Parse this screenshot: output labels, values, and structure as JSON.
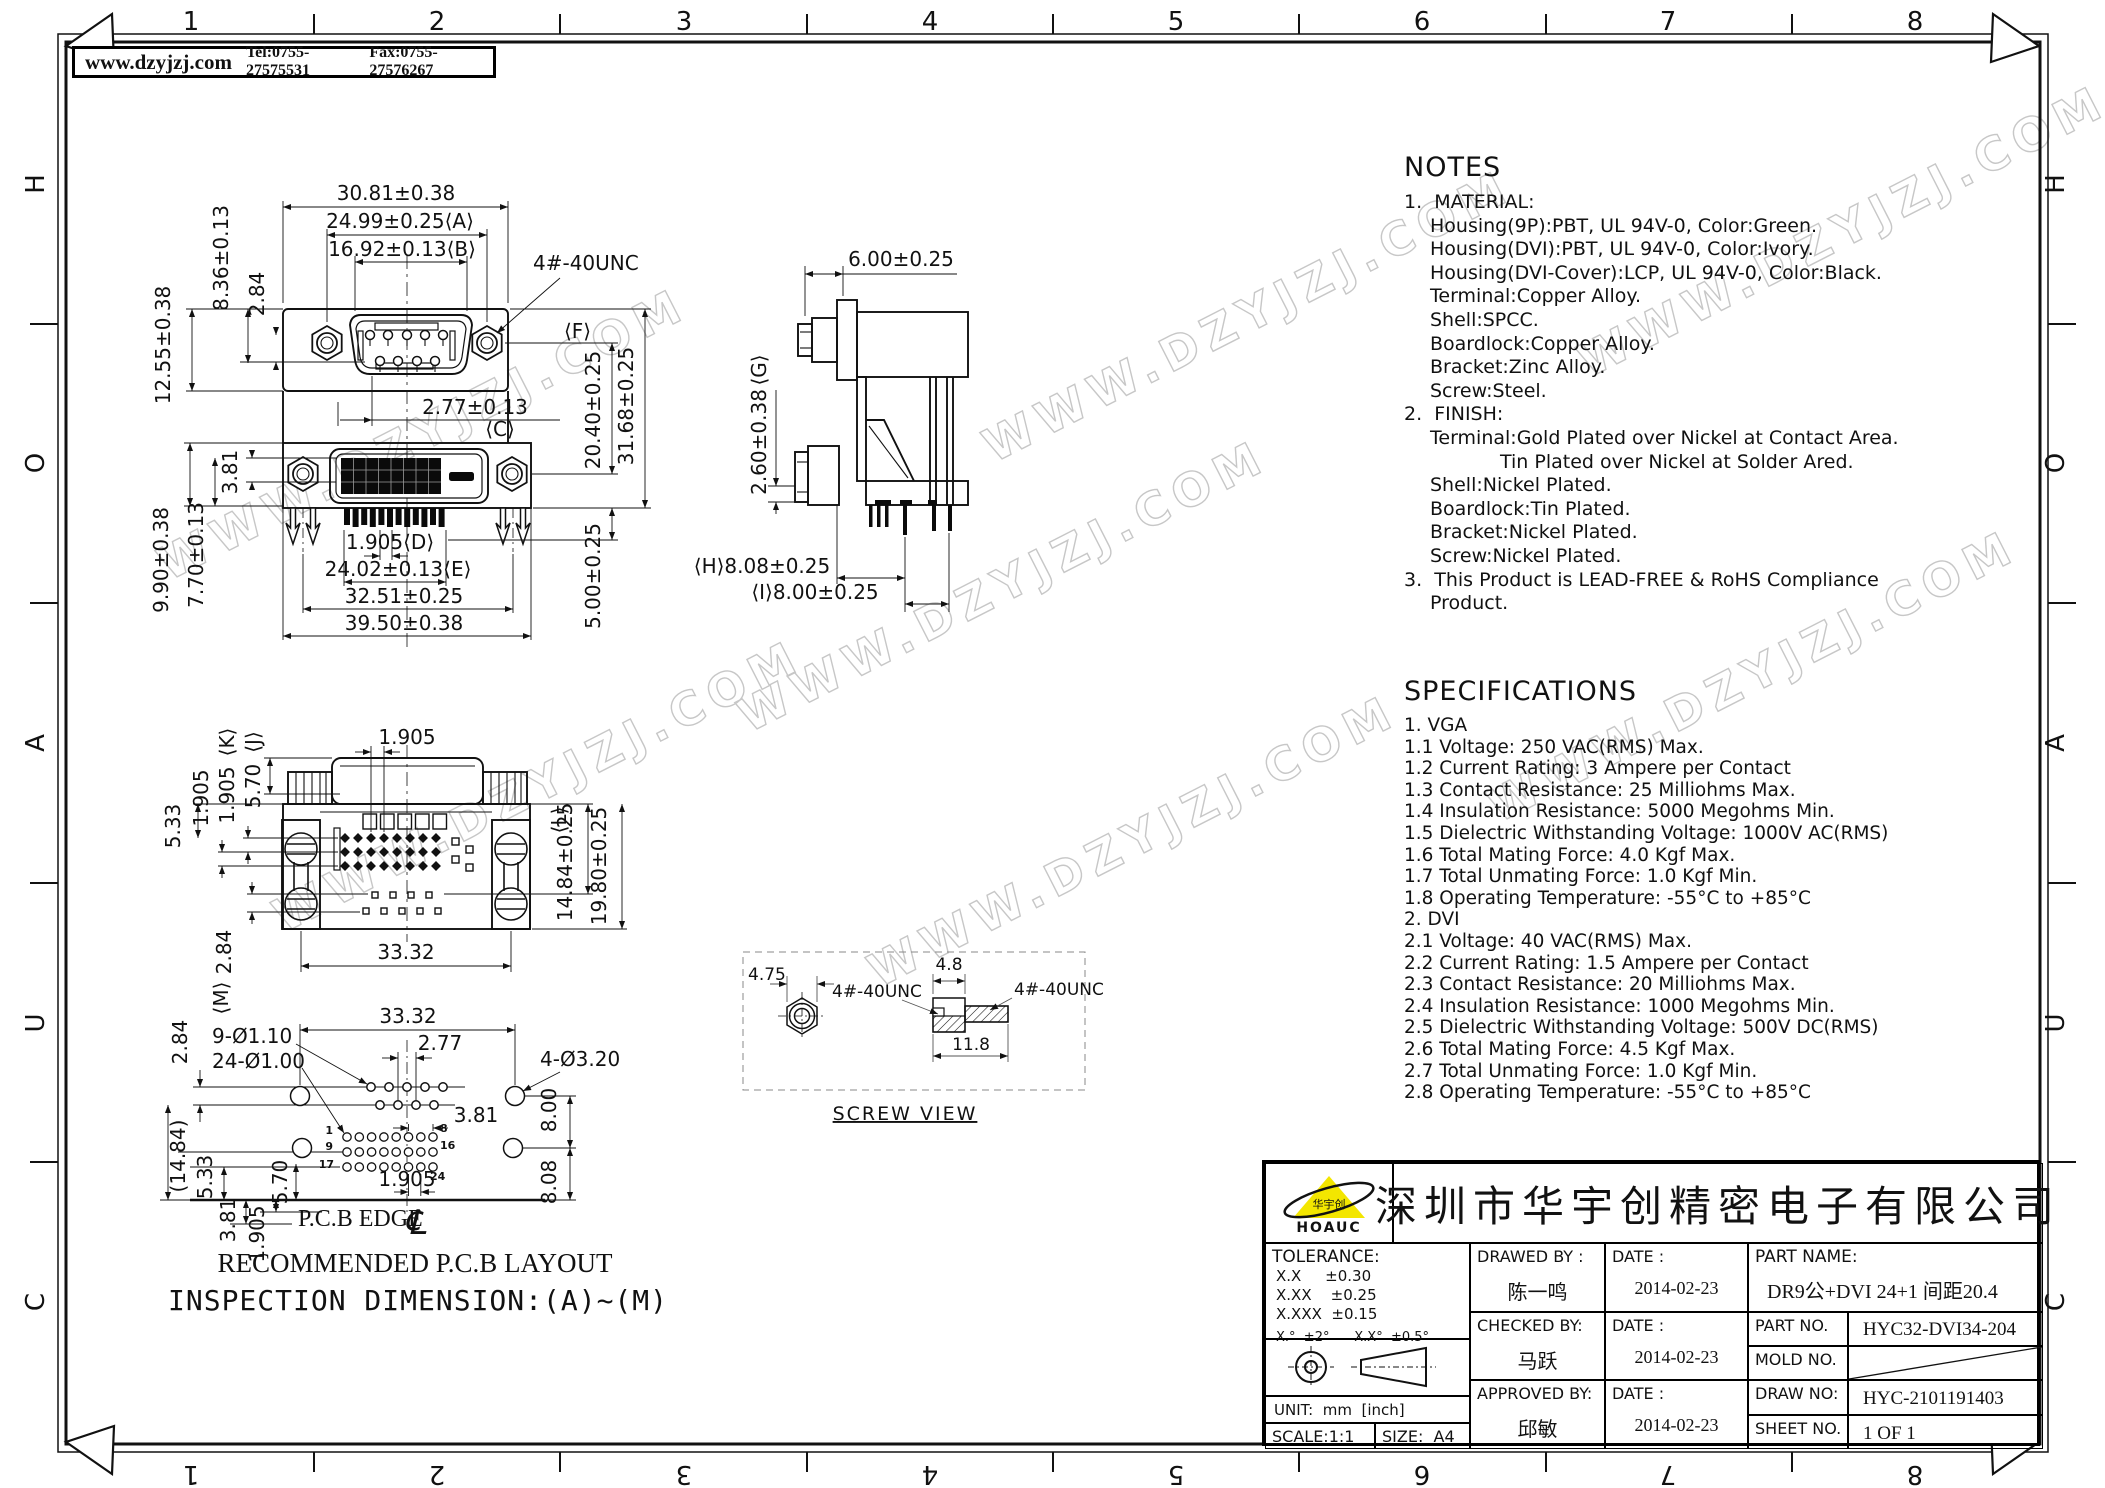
{
  "header": {
    "website": "www.dzyjzj.com",
    "tel": "Tel:0755-27575531",
    "fax": "Fax:0755-27576267"
  },
  "frame": {
    "top_numbers": [
      "1",
      "2",
      "3",
      "4",
      "5",
      "6",
      "7",
      "8"
    ],
    "bottom_numbers": [
      "8",
      "7",
      "6",
      "5",
      "4",
      "3",
      "2",
      "1"
    ],
    "left_letters": [
      "H",
      "O",
      "A",
      "U",
      "C"
    ],
    "right_letters": [
      "H",
      "O",
      "A",
      "U",
      "C"
    ]
  },
  "watermark": "WWW.DZYJZJ.COM",
  "notes": {
    "title": "NOTES",
    "lines": [
      "1.  MATERIAL:",
      "Housing(9P):PBT, UL 94V-0, Color:Green.",
      "Housing(DVI):PBT, UL 94V-0, Color:Ivory.",
      "Housing(DVI-Cover):LCP, UL 94V-0, Color:Black.",
      "Terminal:Copper Alloy.",
      "Shell:SPCC.",
      "Boardlock:Copper Alloy.",
      "Bracket:Zinc Alloy.",
      "Screw:Steel.",
      "2.  FINISH:",
      "Terminal:Gold Plated over Nickel at Contact Area.",
      "Tin Plated over Nickel at Solder Ared.",
      "Shell:Nickel Plated.",
      "Boardlock:Tin Plated.",
      "Bracket:Nickel Plated.",
      "Screw:Nickel Plated.",
      "3.  This Product is LEAD-FREE & RoHS Compliance",
      "Product."
    ]
  },
  "specifications": {
    "title": "SPECIFICATIONS",
    "lines": [
      "1. VGA",
      "1.1 Voltage: 250 VAC(RMS) Max.",
      "1.2 Current Rating: 3 Ampere per Contact",
      "1.3 Contact Resistance: 25 Milliohms Max.",
      "1.4 Insulation Resistance: 5000 Megohms Min.",
      "1.5 Dielectric Withstanding Voltage: 1000V AC(RMS)",
      "1.6 Total Mating Force: 4.0 Kgf Max.",
      "1.7 Total Unmating Force: 1.0 Kgf Min.",
      "1.8 Operating Temperature: -55°C to +85°C",
      "2. DVI",
      "2.1 Voltage: 40 VAC(RMS) Max.",
      "2.2 Current Rating: 1.5 Ampere per Contact",
      "2.3 Contact Resistance: 20 Milliohms Max.",
      "2.4 Insulation Resistance: 1000 Megohms Min.",
      "2.5 Dielectric Withstanding Voltage: 500V DC(RMS)",
      "2.6 Total Mating Force: 4.5 Kgf Max.",
      "2.7 Total Unmating Force: 1.0 Kgf Min.",
      "2.8 Operating Temperature: -55°C to +85°C"
    ]
  },
  "front_view": {
    "w_outer": "30.81±0.38",
    "w_a": "24.99±0.25⟨A⟩",
    "w_b": "16.92±0.13⟨B⟩",
    "h1": "8.36±0.13",
    "h2": "12.55±0.38",
    "h3": "2.84",
    "pitch_c": "2.77±0.13",
    "label_c": "⟨C⟩",
    "thread": "4#-40UNC",
    "label_f": "⟨F⟩",
    "v1": "20.40±0.25",
    "v2": "31.68±0.25",
    "h4": "3.81",
    "h5": "9.90±0.38",
    "h6": "7.70±0.13",
    "pitch_d": "1.905⟨D⟩",
    "w_e": "24.02±0.13⟨E⟩",
    "w4": "32.51±0.25",
    "w5": "39.50±0.38",
    "v3": "5.00±0.25"
  },
  "side_view": {
    "depth": "6.00±0.25",
    "label_g": "⟨G⟩",
    "g": "2.60±0.38",
    "h": "⟨H⟩8.08±0.25",
    "i": "⟨I⟩8.00±0.25"
  },
  "rear_view": {
    "pitch_top": "1.905",
    "label_j": "⟨J⟩",
    "j": "5.70",
    "label_k": "⟨K⟩",
    "k": "1.905",
    "p2": "1.905",
    "p3": "5.33",
    "p4": "2.84",
    "label_m": "⟨M⟩",
    "label_l": "⟨L⟩",
    "l": "14.84±0.25",
    "v": "19.80±0.25",
    "w": "33.32"
  },
  "pcb_view": {
    "w": "33.32",
    "v1": "2.84",
    "c1": "9-Ø1.10",
    "c2": "24-Ø1.00",
    "p1": "2.77",
    "c3": "4-Ø3.20",
    "p2": "3.81",
    "v2": "8.00",
    "v3": "(14.84)",
    "v4": "5.33",
    "v5": "5.70",
    "p3": "1.905",
    "v6": "8.08",
    "v7": "3.81",
    "v8": "1.905",
    "edge": "P.C.B EDGE",
    "cl": "℄",
    "pins": {
      "p1": "1",
      "p8": "8",
      "p9": "9",
      "p16": "16",
      "p17": "17",
      "p24": "24"
    },
    "caption": "RECOMMENDED P.C.B LAYOUT"
  },
  "screw_view": {
    "hex": "4.75",
    "t1": "4#-40UNC",
    "t2": "4#-40UNC",
    "head": "4.8",
    "len": "11.8",
    "caption": "SCREW VIEW"
  },
  "inspection_note": "INSPECTION DIMENSION:(A)~(M)",
  "title_block": {
    "logo_text": "HOAUC",
    "company": "深圳市华宇创精密电子有限公司",
    "tolerance_title": "TOLERANCE:",
    "tol1": "X.X     ±0.30",
    "tol2": "X.XX    ±0.25",
    "tol3": "X.XXX  ±0.15",
    "tol4": "X.°  ±2°      X.X°  ±0.5°",
    "unit": "UNIT:  mm  [inch]",
    "scale": "SCALE:1:1",
    "size": "SIZE:  A4",
    "drawed_by_label": "DRAWED BY :",
    "drawed_by": "陈一鸣",
    "date_label1": "DATE :",
    "date1": "2014-02-23",
    "checked_by_label": "CHECKED BY:",
    "checked_by": "马跃",
    "date_label2": "DATE :",
    "date2": "2014-02-23",
    "approved_by_label": "APPROVED BY:",
    "approved_by": "邱敏",
    "date_label3": "DATE :",
    "date3": "2014-02-23",
    "part_name_label": "PART NAME:",
    "part_name": "DR9公+DVI 24+1 间距20.4",
    "part_no_label": "PART NO.",
    "part_no": "HYC32-DVI34-204",
    "mold_no_label": "MOLD NO.",
    "draw_no_label": "DRAW NO:",
    "draw_no": "HYC-2101191403",
    "sheet_no_label": "SHEET NO.",
    "sheet_no": "1 OF 1"
  }
}
